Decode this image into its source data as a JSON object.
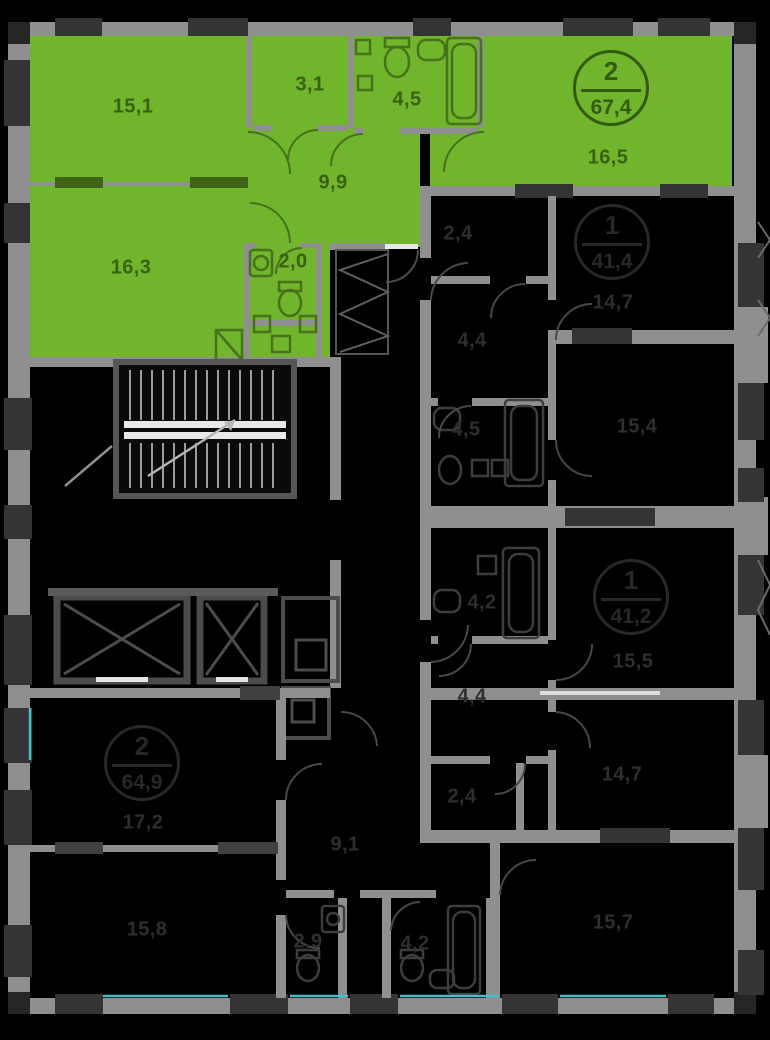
{
  "floor_plan": {
    "background": "#000000",
    "wall_color": "#8f8f8f",
    "highlight_color": "#70b52c",
    "glazing_color": "#3fc1c9",
    "selected_apartment": {
      "badge": {
        "rooms": "2",
        "area": "67,4"
      },
      "rooms": [
        {
          "name": "living-room-1",
          "area": "15,1"
        },
        {
          "name": "wardrobe",
          "area": "3,1"
        },
        {
          "name": "bathroom",
          "area": "4,5"
        },
        {
          "name": "kitchen-living",
          "area": "16,5"
        },
        {
          "name": "hall",
          "area": "9,9"
        },
        {
          "name": "living-room-2",
          "area": "16,3"
        },
        {
          "name": "wc",
          "area": "2,0"
        }
      ]
    },
    "apartments": [
      {
        "badge": {
          "rooms": "1",
          "area": "41,4"
        },
        "rooms": [
          {
            "name": "wardrobe",
            "area": "2,4"
          },
          {
            "name": "hall",
            "area": "4,4"
          },
          {
            "name": "bathroom",
            "area": "4,5"
          },
          {
            "name": "living-room",
            "area": "14,7"
          },
          {
            "name": "kitchen",
            "area": "15,4"
          }
        ]
      },
      {
        "badge": {
          "rooms": "1",
          "area": "41,2"
        },
        "rooms": [
          {
            "name": "bathroom",
            "area": "4,2"
          },
          {
            "name": "hall",
            "area": "4,4"
          },
          {
            "name": "wardrobe",
            "area": "2,4"
          },
          {
            "name": "kitchen",
            "area": "15,5"
          },
          {
            "name": "living-room",
            "area": "14,7"
          }
        ]
      },
      {
        "badge": {
          "rooms": "2",
          "area": "64,9"
        },
        "rooms": [
          {
            "name": "living-room-1",
            "area": "17,2"
          },
          {
            "name": "living-room-2",
            "area": "15,8"
          },
          {
            "name": "hall",
            "area": "9,1"
          },
          {
            "name": "bathroom",
            "area": "2,9"
          },
          {
            "name": "wc",
            "area": "4,2"
          },
          {
            "name": "kitchen",
            "area": "15,7"
          }
        ]
      }
    ]
  }
}
